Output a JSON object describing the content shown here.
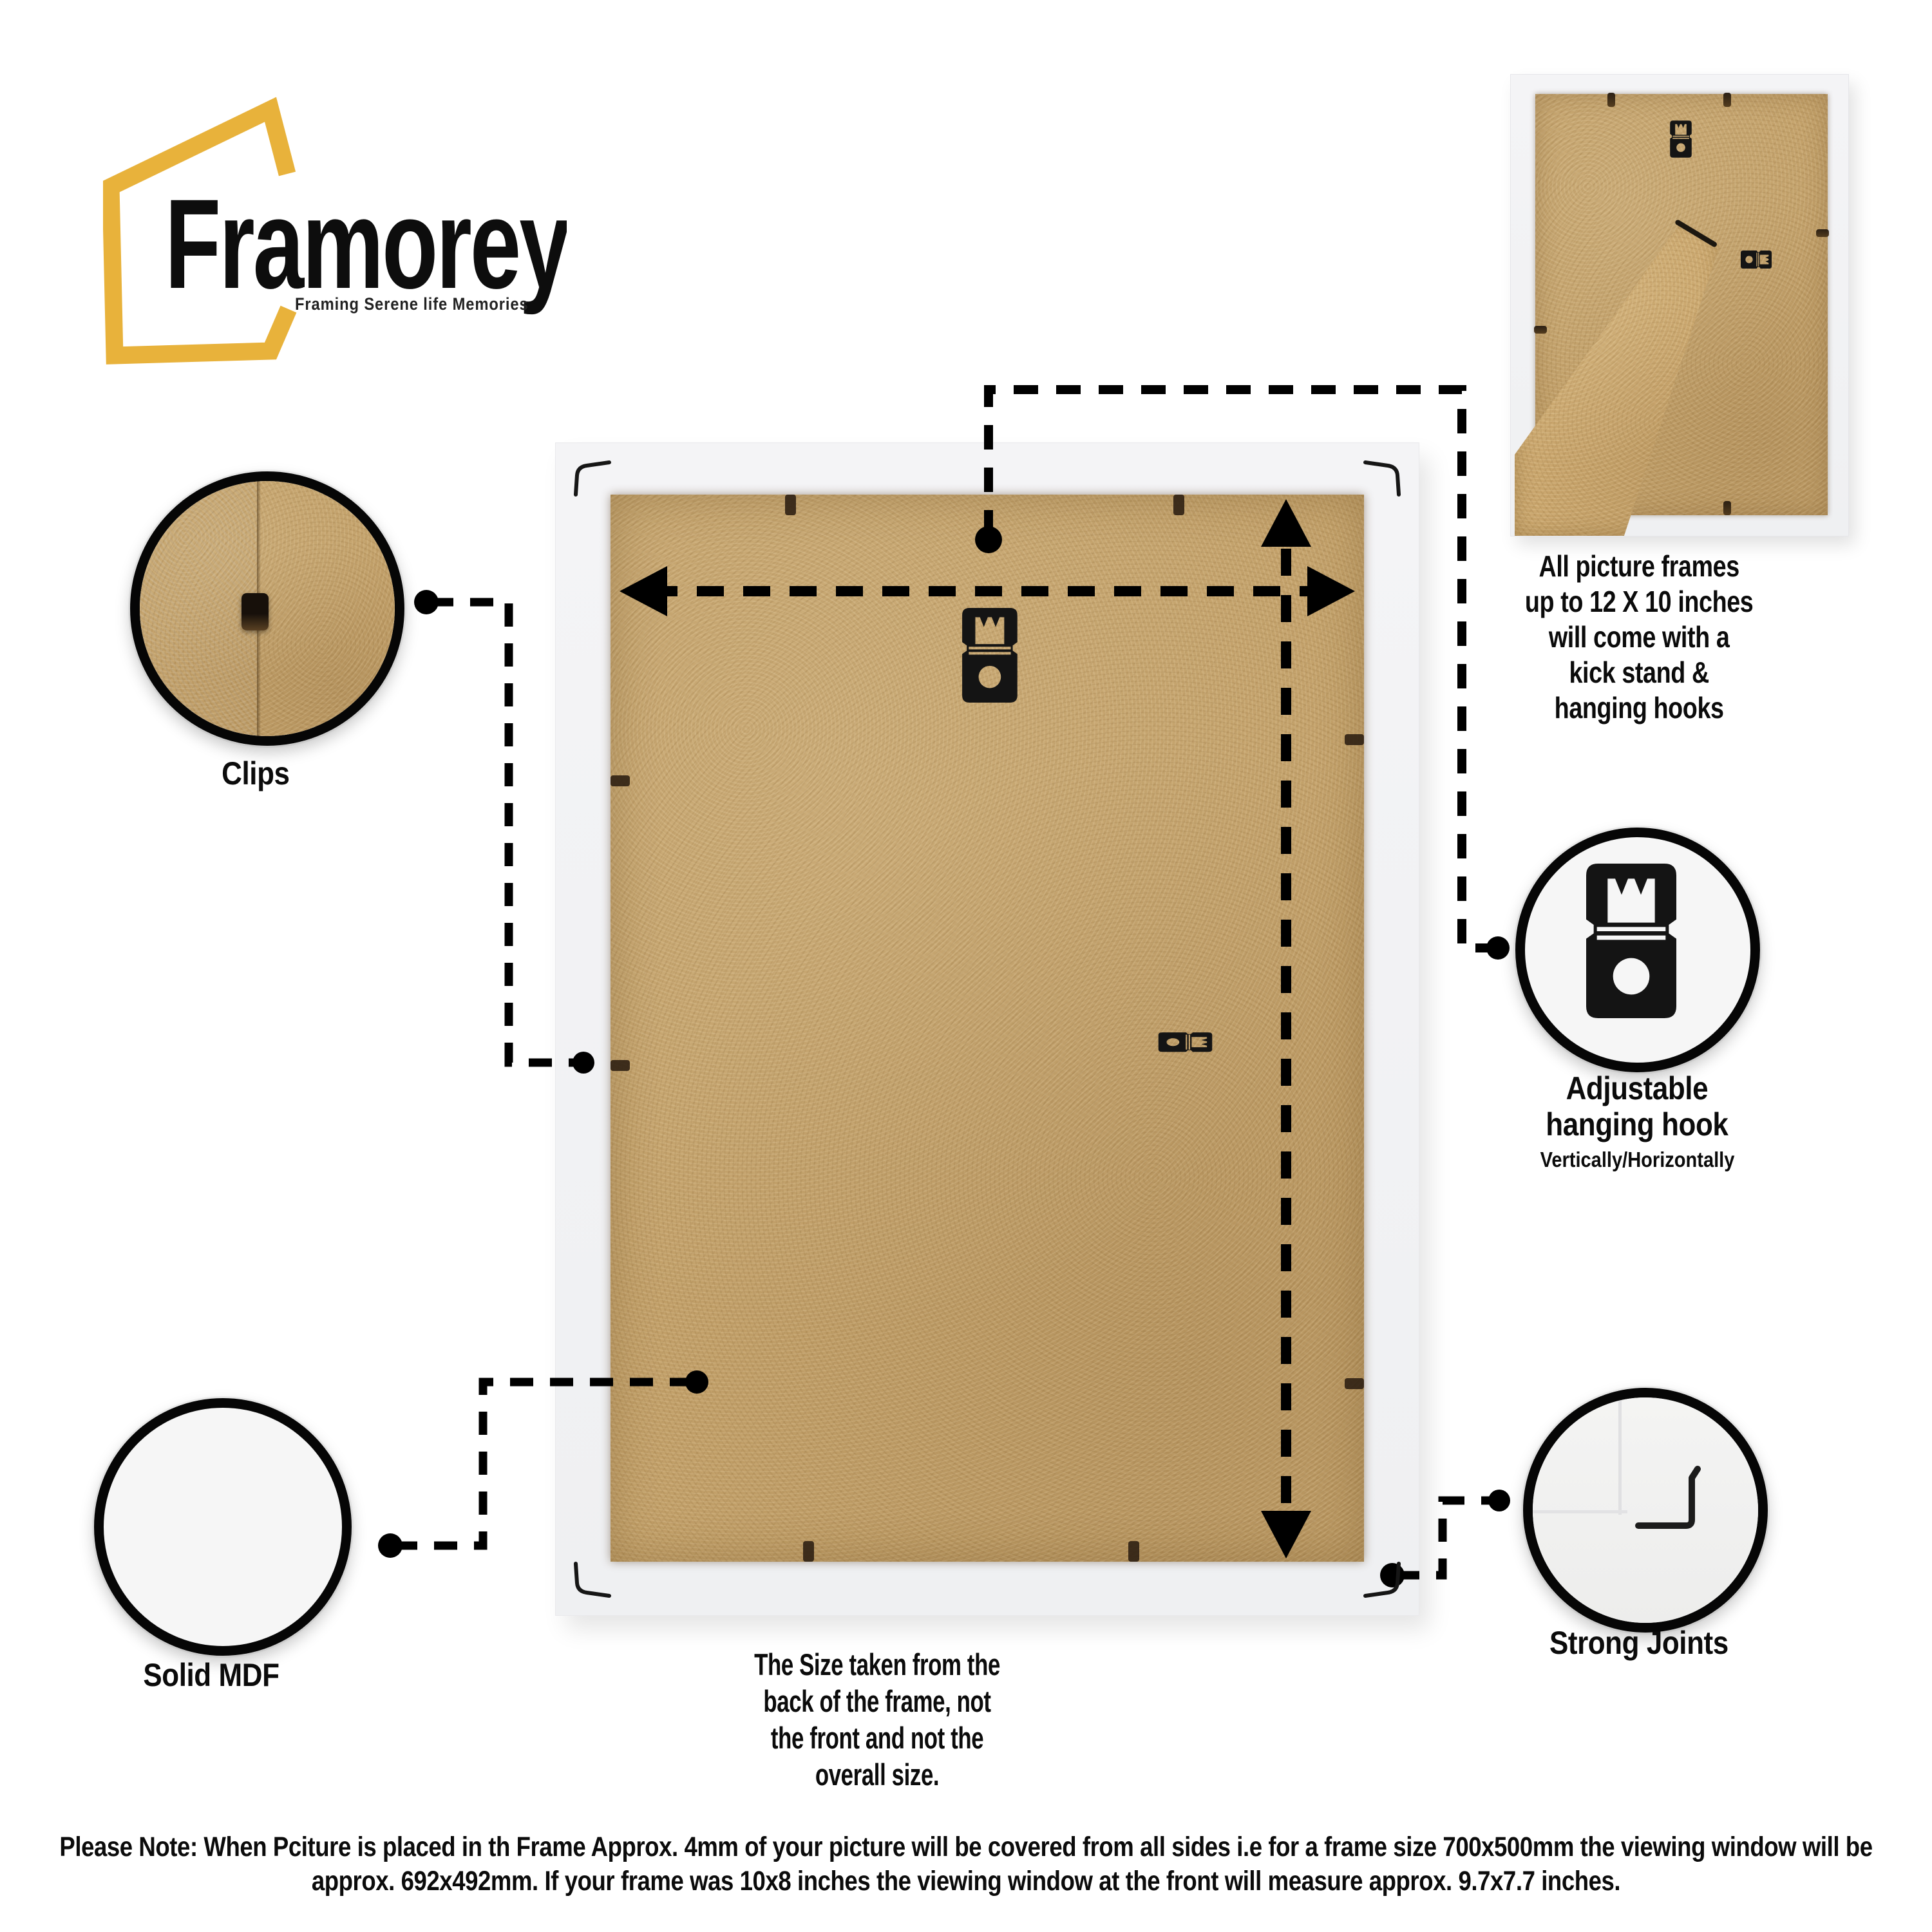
{
  "brand": {
    "name": "Framorey",
    "tagline": "Framing Serene life Memories"
  },
  "inset_caption": {
    "lines": [
      "All picture frames",
      "up to 12 X 10 inches",
      "will come with a",
      "kick stand &",
      "hanging hooks"
    ]
  },
  "callouts": {
    "clips": {
      "label": "Clips"
    },
    "adjustable": {
      "label_lines": [
        "Adjustable",
        "hanging hook"
      ],
      "sub": "Vertically/Horizontally"
    },
    "solid_mdf": {
      "label": "Solid MDF"
    },
    "strong_joints": {
      "label": "Strong Joints"
    }
  },
  "size_note": {
    "lines": [
      "The Size taken from the",
      "back of the frame, not",
      "the front and not the",
      "overall size."
    ]
  },
  "footer_note": "Please Note: When Pciture is placed in th Frame Approx. 4mm of your picture will be covered from all sides i.e for a frame size 700x500mm the viewing window will be approx. 692x492mm. If your frame was 10x8 inches the viewing window at the front will measure approx. 9.7x7.7 inches.",
  "colors": {
    "accent": "#E8B23B",
    "mdf": "#C2A069",
    "frame_white": "#F2F2F4",
    "ink": "#0B0B0B"
  }
}
